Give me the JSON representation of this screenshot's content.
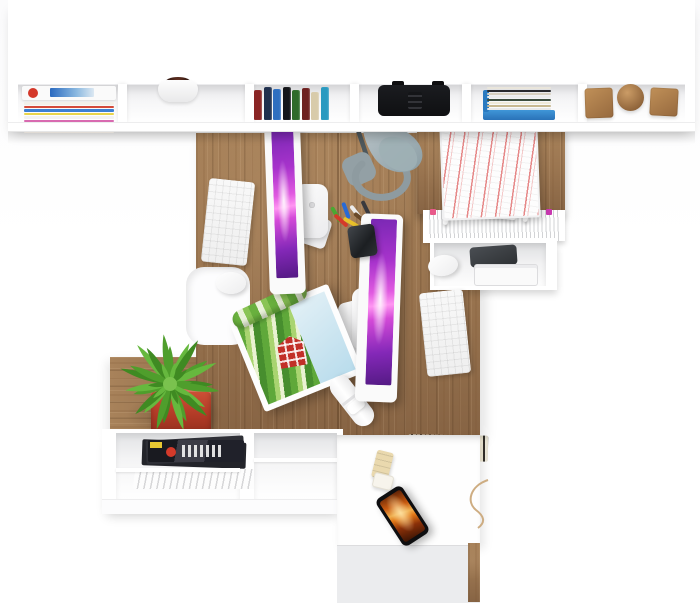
{
  "scene": {
    "description": "Top-down 3D render of a home office: wall shelf with books and decor, L-shaped wood desk with two iMacs, keyboards, mice, desk lamp, pen cup, rolled landscape poster, potted succulent, wire paper tray, hanging files, printer cubby, lower shelf with magazines and shopping bag, and a white cabinet with phone and USB stick."
  },
  "palette": {
    "wood": "#9a7550",
    "wood_light": "#a8825a",
    "wood_dark": "#876444",
    "screen_top": "#7a28b4",
    "screen_mid": "#e05ae0",
    "screen_glow": "#ff96f2",
    "pot": "#d05238",
    "bag_orange": "#e06a35",
    "phone_flame_a": "#8a3008",
    "phone_flame_b": "#f0b050",
    "lamp_shade": "#a7b2b6",
    "lamp_base": "#8e9ba0"
  },
  "top_shelf": {
    "compartments": [
      "magazine-stack",
      "potted-plant",
      "book-row",
      "black-speaker",
      "horizontal-book-stack",
      "wooden-shapes"
    ],
    "magazine_stripes": [
      {
        "c": "#f2f0ea",
        "h": 3
      },
      {
        "c": "#d44a3a",
        "h": 2
      },
      {
        "c": "#3a7fd4",
        "h": 3
      },
      {
        "c": "#e8d44a",
        "h": 2
      },
      {
        "c": "#f2f2f2",
        "h": 3
      },
      {
        "c": "#d86ab0",
        "h": 2
      },
      {
        "c": "#e9e9e9",
        "h": 3
      },
      {
        "c": "#4aa8d8",
        "h": 2
      },
      {
        "c": "#f5f0e8",
        "h": 3
      }
    ],
    "book_spines": [
      {
        "c": "#8a2525",
        "h": 30
      },
      {
        "c": "#20304e",
        "h": 33
      },
      {
        "c": "#2f6fc0",
        "h": 31
      },
      {
        "c": "#15161a",
        "h": 33
      },
      {
        "c": "#2f6b2a",
        "h": 30
      },
      {
        "c": "#6e2020",
        "h": 32
      },
      {
        "c": "#d8cbaa",
        "h": 28
      },
      {
        "c": "#2a9ac0",
        "h": 33
      }
    ],
    "stack_stripes": [
      {
        "c": "#e9e5db",
        "h": 3
      },
      {
        "c": "#2a2a2e",
        "h": 2
      },
      {
        "c": "#d8d0c0",
        "h": 3
      },
      {
        "c": "#ececec",
        "h": 2
      },
      {
        "c": "#3d4d3d",
        "h": 3
      },
      {
        "c": "#f0ead8",
        "h": 2
      },
      {
        "c": "#c8b890",
        "h": 3
      },
      {
        "c": "#e8e8e8",
        "h": 2
      }
    ],
    "wooden_shapes": [
      "cube",
      "sphere",
      "cube"
    ]
  },
  "desk": {
    "monitors": 2,
    "keyboards": 2,
    "mice": 2,
    "pens": [
      {
        "c": "#4aa832",
        "r": -30,
        "m": 6
      },
      {
        "c": "#d43a2a",
        "r": -48,
        "m": 12
      },
      {
        "c": "#2a6ad4",
        "r": -20,
        "m": 2
      },
      {
        "c": "#e8c02a",
        "r": -60,
        "m": 14
      },
      {
        "c": "#ececec",
        "r": -38,
        "m": 4
      },
      {
        "c": "#6a4a2a",
        "r": -52,
        "m": 10
      },
      {
        "c": "#3a3a3e",
        "r": -26,
        "m": 0
      }
    ],
    "plant": {
      "leaf_count": 22,
      "leaf_colors": [
        "#4f9e2c",
        "#66b83e",
        "#3f8a22"
      ],
      "center_color": "#7ac24e"
    }
  },
  "right_storage": {
    "file_tabs": [
      {
        "c": "#e85a8a"
      },
      {
        "c": "#e8c832"
      },
      {
        "c": "#5ab44a"
      },
      {
        "c": "#3a7fd4"
      },
      {
        "c": "#9a5ad4"
      },
      {
        "c": "#e8883a"
      },
      {
        "c": "#4ac8d8"
      },
      {
        "c": "#d44a3a"
      },
      {
        "c": "#68c84a"
      },
      {
        "c": "#c838b0"
      }
    ]
  }
}
